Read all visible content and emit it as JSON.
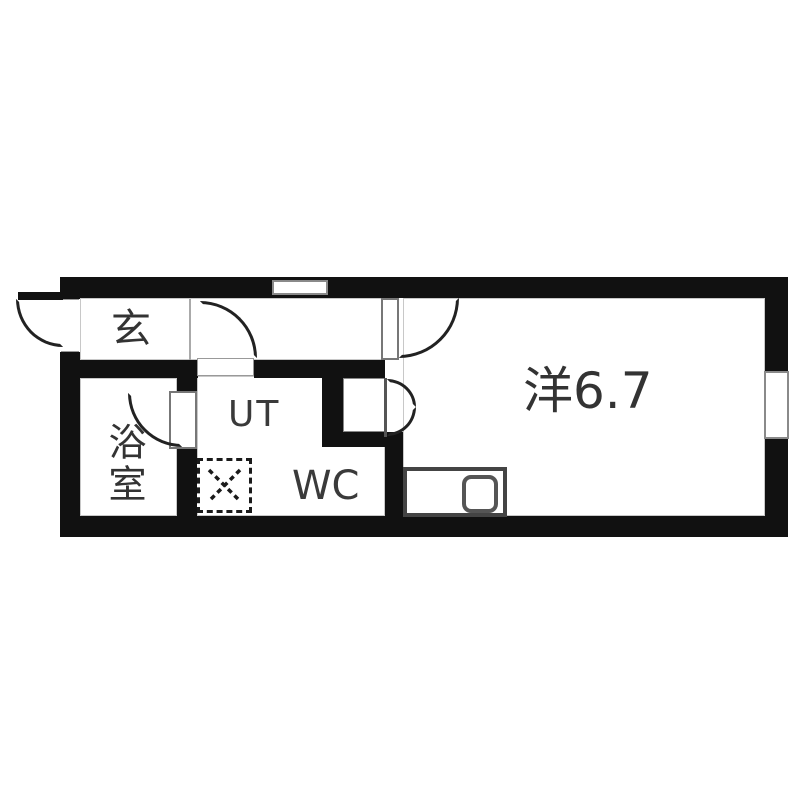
{
  "floorplan": {
    "title": "apartment-floor-plan",
    "labels": {
      "entrance": "玄",
      "bathroom": "浴室",
      "utility": "UT",
      "toilet": "WC",
      "main_room": "洋6.7"
    },
    "fixtures": {
      "washing_machine": "dashed-square-with-x",
      "kitchen_sink": "rounded-square",
      "windows": [
        "top-wall-window",
        "right-wall-window"
      ],
      "doors": [
        "entrance-swing-out",
        "utility-swing-door",
        "main-room-swing-door",
        "bathroom-swing-door",
        "closet-bifold-door"
      ]
    },
    "colors": {
      "wall": "#111111",
      "door_line": "#222222",
      "frame_gray": "#888888",
      "text": "#333333",
      "background": "#ffffff"
    }
  }
}
